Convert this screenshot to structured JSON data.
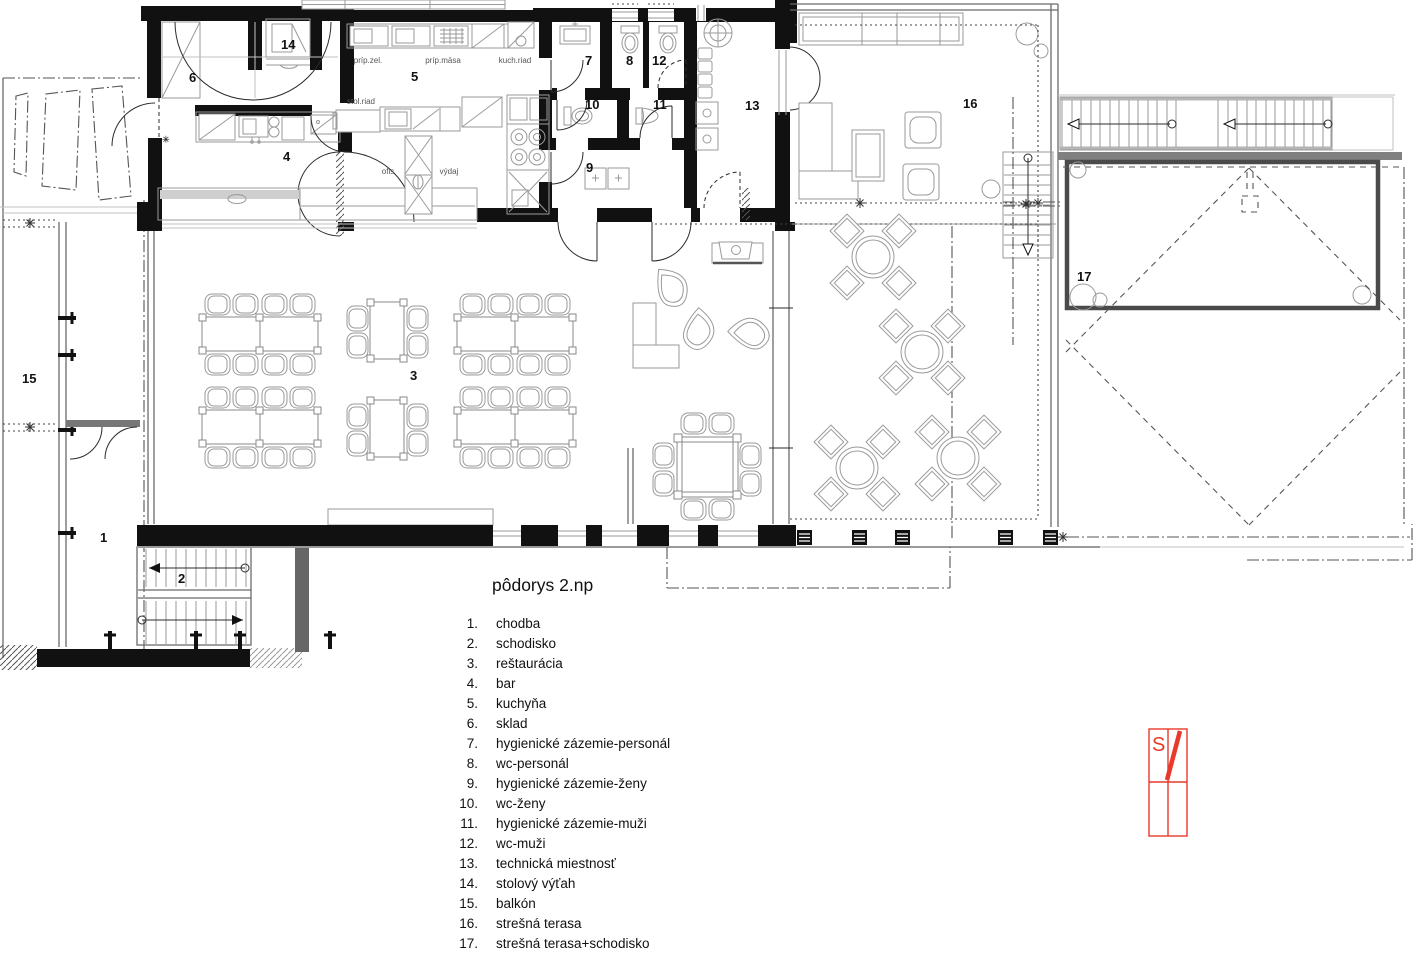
{
  "title": "pôdorys 2.np",
  "legend": {
    "items": [
      {
        "num": "1.",
        "label": "chodba"
      },
      {
        "num": "2.",
        "label": "schodisko"
      },
      {
        "num": "3.",
        "label": "reštaurácia"
      },
      {
        "num": "4.",
        "label": "bar"
      },
      {
        "num": "5.",
        "label": "kuchyňa"
      },
      {
        "num": "6.",
        "label": "sklad"
      },
      {
        "num": "7.",
        "label": "hygienické zázemie-personál"
      },
      {
        "num": "8.",
        "label": "wc-personál"
      },
      {
        "num": "9.",
        "label": "hygienické zázemie-ženy"
      },
      {
        "num": "10.",
        "label": "wc-ženy"
      },
      {
        "num": "11.",
        "label": "hygienické zázemie-muži"
      },
      {
        "num": "12.",
        "label": "wc-muži"
      },
      {
        "num": "13.",
        "label": "technická miestnosť"
      },
      {
        "num": "14.",
        "label": "stolový výťah"
      },
      {
        "num": "15.",
        "label": "balkón"
      },
      {
        "num": "16.",
        "label": "strešná terasa"
      },
      {
        "num": "17.",
        "label": "strešná terasa+schodisko"
      }
    ]
  },
  "plan": {
    "room_numbers": {
      "n1": "1",
      "n2": "2",
      "n3": "3",
      "n4": "4",
      "n5": "5",
      "n6": "6",
      "n7": "7",
      "n8": "8",
      "n9": "9",
      "n10": "10",
      "n11": "11",
      "n12": "12",
      "n13": "13",
      "n14": "14",
      "n15": "15",
      "n16": "16",
      "n17": "17"
    },
    "annotations": {
      "prip_zel": "príp.zel.",
      "prip_masa": "príp.mäsa",
      "kuch_riad": "kuch.riad",
      "stol_riad": "stol.riad",
      "ofis": "ofis",
      "vydaj": "výdaj"
    }
  },
  "north_arrow": {
    "letter": "S"
  },
  "colors": {
    "wall": "#111111",
    "furniture_line": "#9a9a9a",
    "accent_red": "#e8392a",
    "background": "#ffffff"
  }
}
